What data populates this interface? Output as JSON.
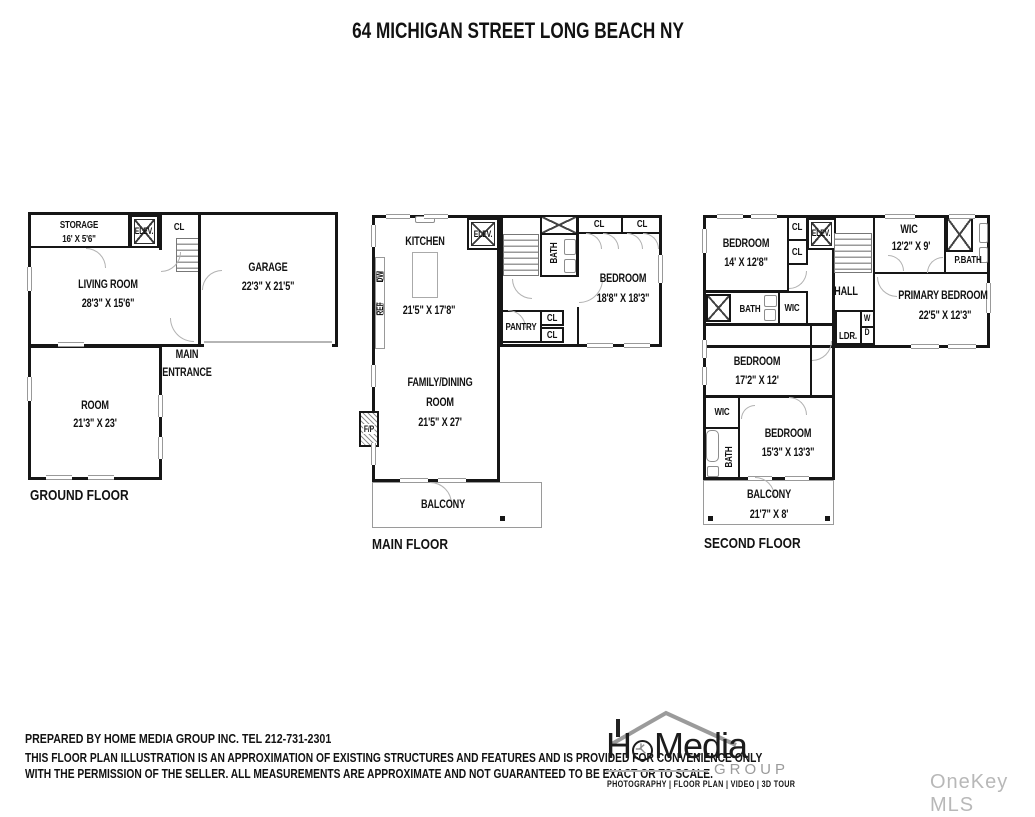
{
  "title": "64 MICHIGAN STREET LONG BEACH NY",
  "ground": {
    "floor_label": "GROUND FLOOR",
    "storage_name": "STORAGE",
    "storage_dims": "16' X 5'6\"",
    "elev": "ELEV.",
    "cl": "CL",
    "living_name": "LIVING ROOM",
    "living_dims": "28'3\" X 15'6\"",
    "garage_name": "GARAGE",
    "garage_dims": "22'3\" X 21'5\"",
    "entrance_line1": "MAIN",
    "entrance_line2": "ENTRANCE",
    "room_name": "ROOM",
    "room_dims": "21'3\" X 23'"
  },
  "main": {
    "floor_label": "MAIN FLOOR",
    "kitchen_name": "KITCHEN",
    "kitchen_dims": "21'5\" X 17'8\"",
    "elev": "ELEV.",
    "bath": "BATH",
    "dw": "DW",
    "ref": "REF",
    "cl_top_left": "CL",
    "cl_top_right": "CL",
    "bedroom_name": "BEDROOM",
    "bedroom_dims": "18'8\" X 18'3\"",
    "pantry": "PANTRY",
    "cl_mid_top": "CL",
    "cl_mid_bottom": "CL",
    "family_line1": "FAMILY/DINING",
    "family_line2": "ROOM",
    "family_dims": "21'5\" X 27'",
    "fp": "F/P",
    "balcony": "BALCONY"
  },
  "second": {
    "floor_label": "SECOND FLOOR",
    "bedroom1_name": "BEDROOM",
    "bedroom1_dims": "14' X 12'8\"",
    "cl1": "CL",
    "cl2": "CL",
    "elev": "ELEV.",
    "wic_top_name": "WIC",
    "wic_top_dims": "12'2\" X 9'",
    "pbath": "P.BATH",
    "hall": "HALL",
    "ldr": "LDR.",
    "w": "W",
    "d": "D",
    "primary_name": "PRIMARY BEDROOM",
    "primary_dims": "22'5\" X 12'3\"",
    "bath_mid": "BATH",
    "wic_mid": "WIC",
    "bedroom2_name": "BEDROOM",
    "bedroom2_dims": "17'2\" X 12'",
    "wic_low": "WIC",
    "bath_low": "BATH",
    "bedroom3_name": "BEDROOM",
    "bedroom3_dims": "15'3\" X 13'3\"",
    "balcony_name": "BALCONY",
    "balcony_dims": "21'7\" X 8'"
  },
  "footer": {
    "line1": "PREPARED BY  HOME MEDIA GROUP INC.  TEL 212-731-2301",
    "line2": "THIS FLOOR PLAN ILLUSTRATION IS AN APPROXIMATION OF EXISTING STRUCTURES AND FEATURES AND IS PROVIDED FOR CONVENIENCE ONLY",
    "line3": "WITH THE PERMISSION OF THE SELLER. ALL MEASUREMENTS ARE APPROXIMATE AND NOT GUARANTEED TO BE EXACT OR TO SCALE."
  },
  "logo": {
    "brand_h": "H",
    "brand_rest": "Media",
    "group": "GROUP",
    "services": "PHOTOGRAPHY  |  FLOOR PLAN  |  VIDEO  |  3D TOUR"
  },
  "watermark": "OneKey MLS",
  "colors": {
    "wall": "#161616",
    "gray_accent": "#9a9a9a",
    "watermark": "#b8b8b8"
  }
}
